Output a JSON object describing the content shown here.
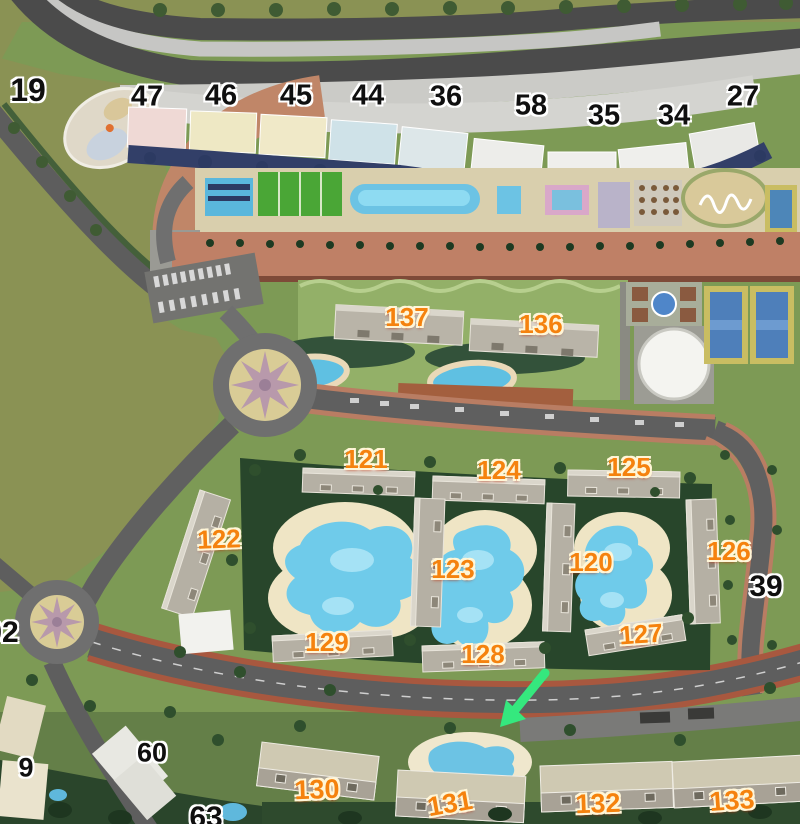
{
  "map": {
    "description_visible": "aerial master plan with numbered buildings, pools, roads and roundabouts",
    "labels": {
      "l19": "19",
      "l47": "47",
      "l46": "46",
      "l45": "45",
      "l44": "44",
      "l36": "36",
      "l58": "58",
      "l35": "35",
      "l34": "34",
      "l27": "27",
      "l137": "137",
      "l136": "136",
      "l121": "121",
      "l124": "124",
      "l125": "125",
      "l122": "122",
      "l123": "123",
      "l120": "120",
      "l126": "126",
      "l39": "39",
      "l02": "02",
      "l129": "129",
      "l128": "128",
      "l127": "127",
      "l60": "60",
      "l9": "9",
      "l130": "130",
      "l131": "131",
      "l132": "132",
      "l133": "133",
      "l63": "63"
    },
    "arrow": {
      "color": "#35e87e",
      "direction": "down-left"
    },
    "colors": {
      "label_orange": "#f5820e",
      "label_black": "#0f0f0f",
      "pool_blue": "#6fcbea",
      "grass": "#7d9a55",
      "olive_field": "#8a9254",
      "road_gray": "#5e5e5e",
      "brick_promenade": "#bf8066",
      "bike_lane_red": "#a8583f",
      "sand": "#efe5c5",
      "court_green": "#4aa636",
      "tennis_blue": "#4e7fba",
      "navy_trees": "#323f68",
      "arrow_green": "#35e87e"
    }
  }
}
